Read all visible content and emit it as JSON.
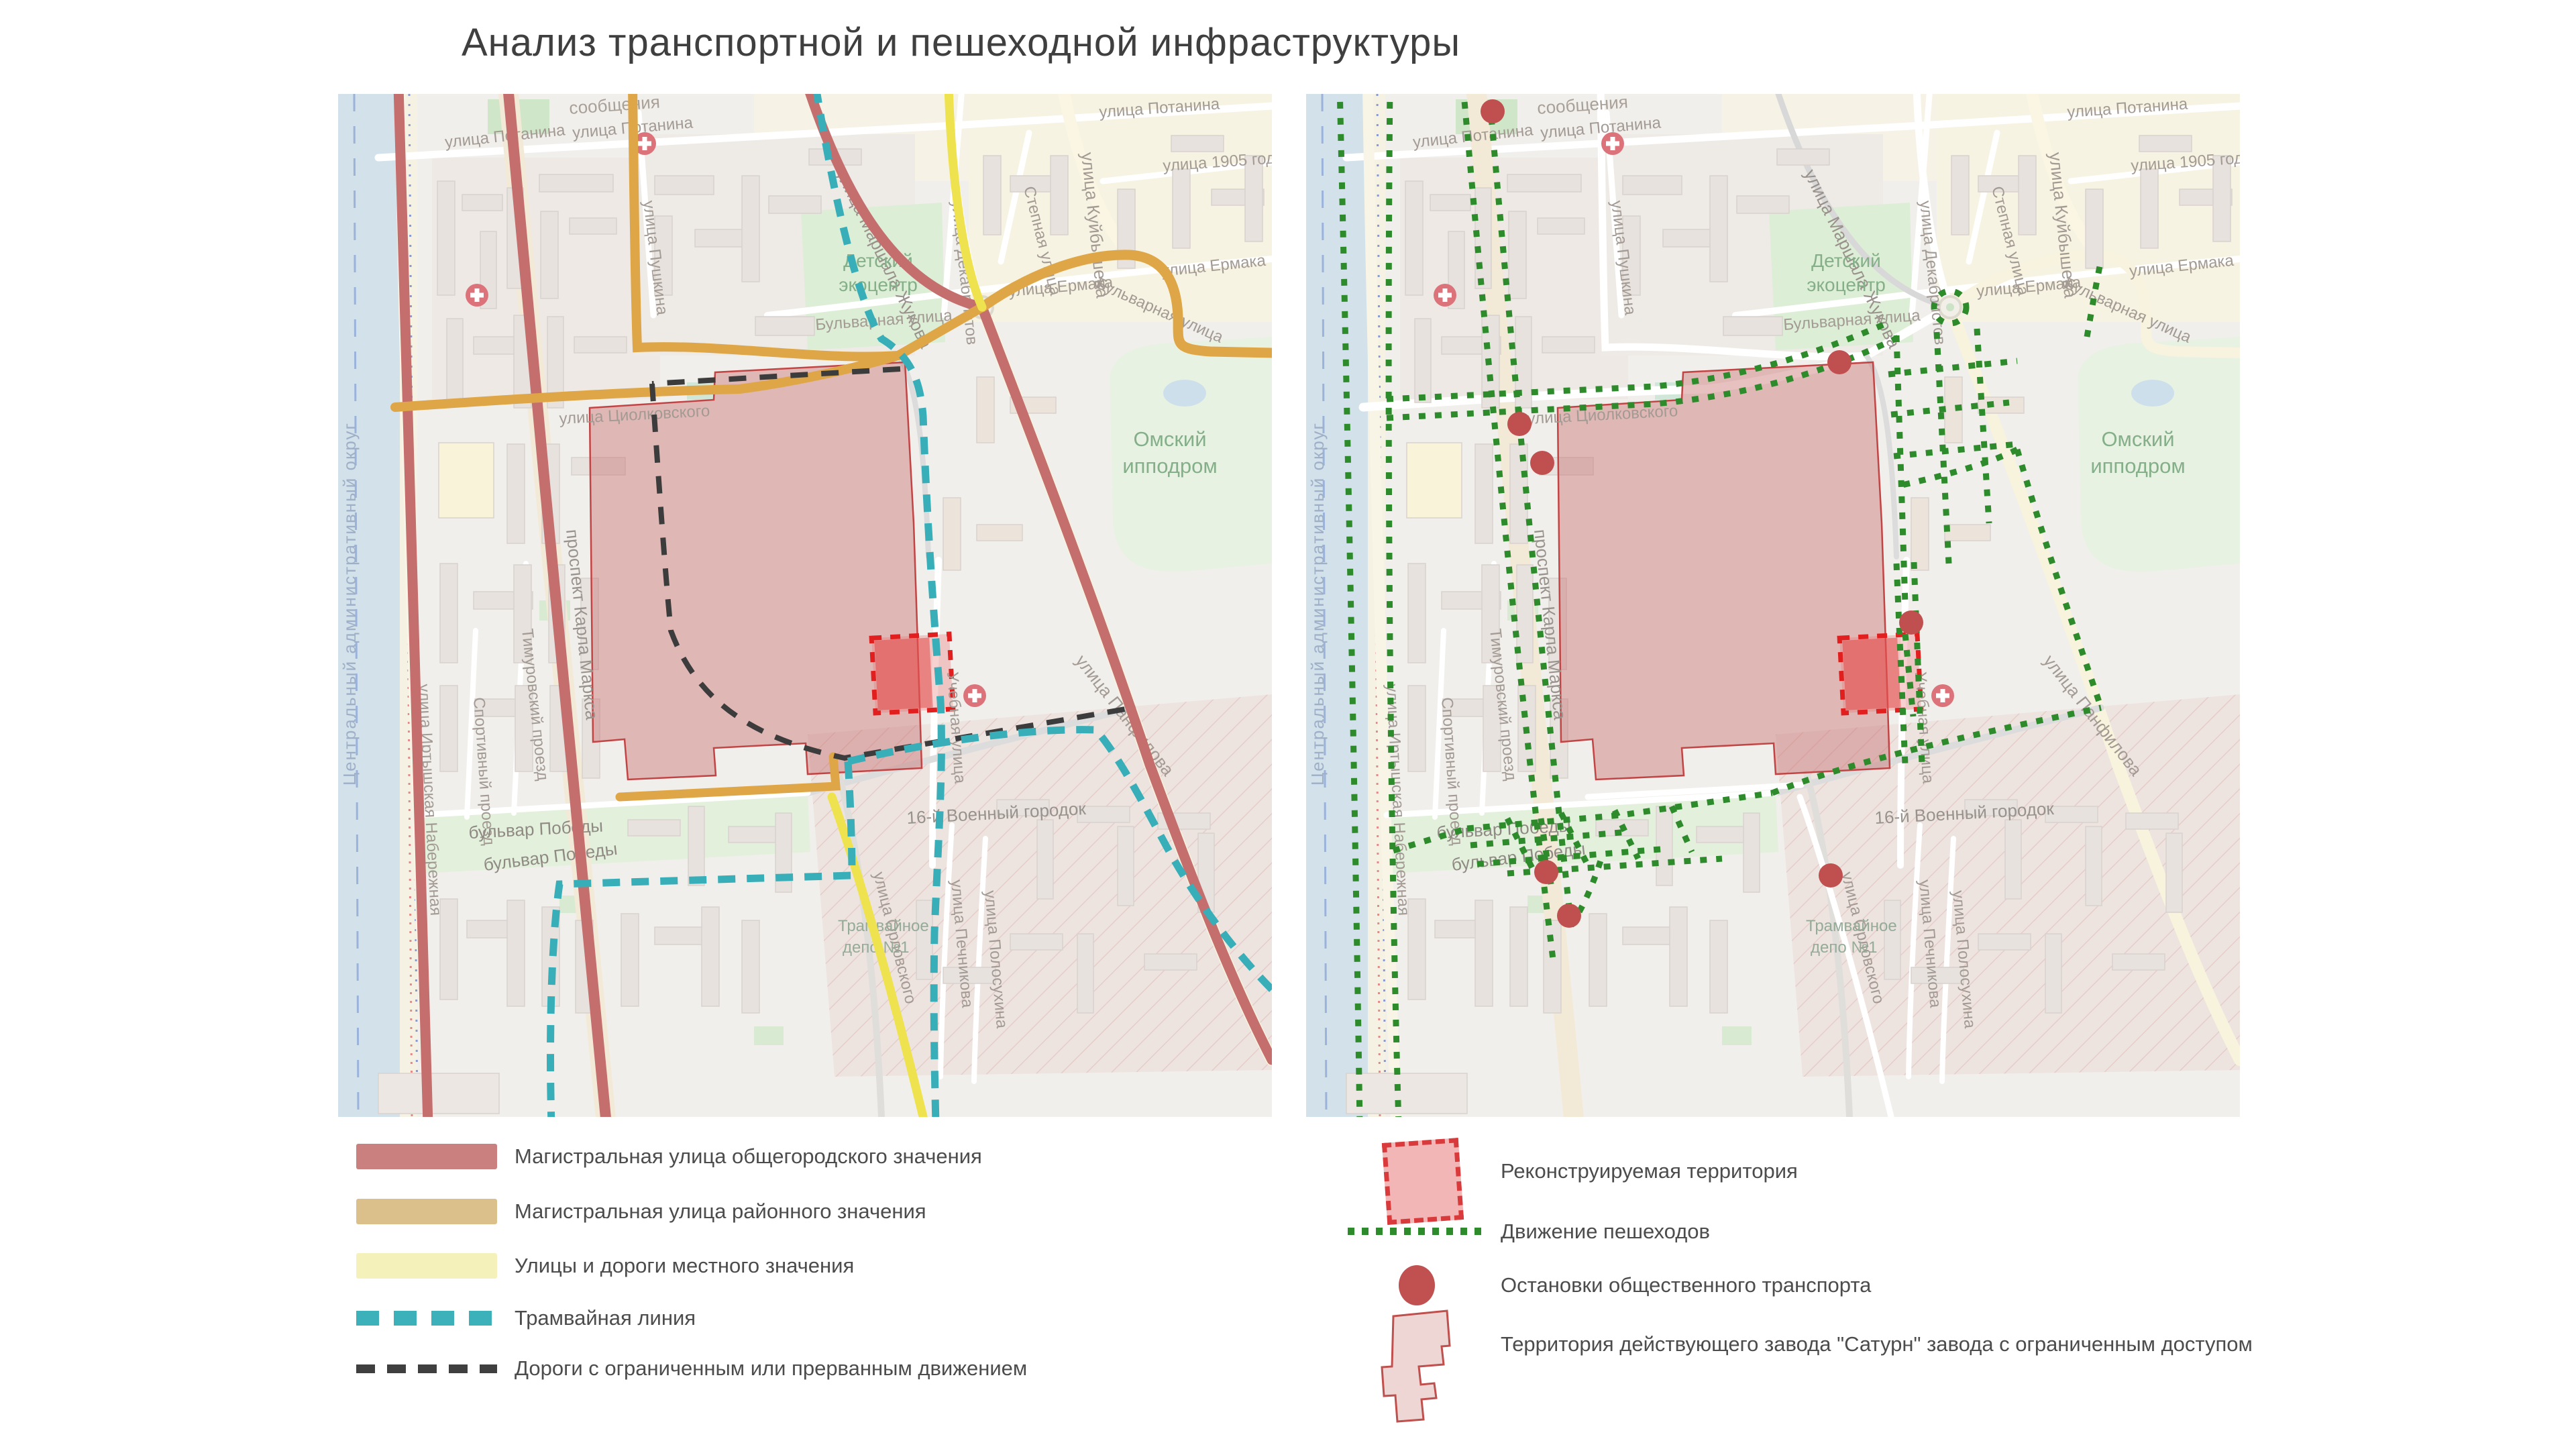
{
  "title": "Анализ транспортной и пешеходной инфраструктуры",
  "colors": {
    "road_city": "#c46e6d",
    "road_district": "#dfa648",
    "road_local_map": "#efe24f",
    "road_local_legend": "#f4f1bb",
    "tram": "#38aeb8",
    "restricted": "#3c3c3c",
    "pedestrian": "#2e8b2c",
    "stop": "#bf504f",
    "factory_fill": "#e8c2c2",
    "reconstruction_border": "#e21f1f",
    "water": "#d2e1ea"
  },
  "legend_left": {
    "items": [
      {
        "label": "Магистральная улица общегородского значения",
        "type": "swatch",
        "color": "#c9807f"
      },
      {
        "label": "Магистральная улица районного значения",
        "type": "swatch",
        "color": "#dcc08c"
      },
      {
        "label": "Улицы и дороги местного значения",
        "type": "swatch",
        "color": "#f4f1bb"
      },
      {
        "label": "Трамвайная линия",
        "type": "tram-dash"
      },
      {
        "label": "Дороги с ограниченным или прерванным движением",
        "type": "black-dash"
      }
    ]
  },
  "legend_right": {
    "items": [
      {
        "label": "Реконструируемая территория",
        "type": "recon-square"
      },
      {
        "label": "Движение пешеходов",
        "type": "green-dots"
      },
      {
        "label": "Остановки общественного транспорта",
        "type": "stop-circle"
      },
      {
        "label": "Территория действующего завода \"Сатурн\" завода с ограниченным доступом",
        "type": "factory-shape"
      }
    ]
  },
  "map_labels": {
    "okrug": "Центральный административный округ",
    "soobshcheniya": "сообщения",
    "potanina": "улица Потанина",
    "pushkina": "улица Пушкина",
    "zhukova": "улица Маршала Жукова",
    "dekabristov": "улица Декабристов",
    "stepnaya": "Степная улица",
    "kuybysheva": "улица Куйбышева",
    "god1905": "улица 1905 года",
    "ermaka": "улица Ермака",
    "detsky1": "Детский",
    "detsky2": "экоцентр",
    "ippodrom1": "Омский",
    "ippodrom2": "ипподром",
    "bulvarnaya": "Бульварная улица",
    "tsiolkovskogo": "улица Циолковского",
    "marksa": "проспект Карла Маркса",
    "naberezhnaya": "улица Иртышская Набережная",
    "sportivny": "Спортивный проезд",
    "timurovsky": "Тимуровский проезд",
    "pobedy": "бульвар Победы",
    "uchebnaya": "Учебная улица",
    "pechnikova": "улица Печникова",
    "polosukhina": "улица Полосухина",
    "gorodok": "16-й Военный городок",
    "panfilova": "улица Панфилова",
    "orlovskogo": "улица Орловского",
    "depo1": "Трамвайное",
    "depo2": "депо №1"
  }
}
